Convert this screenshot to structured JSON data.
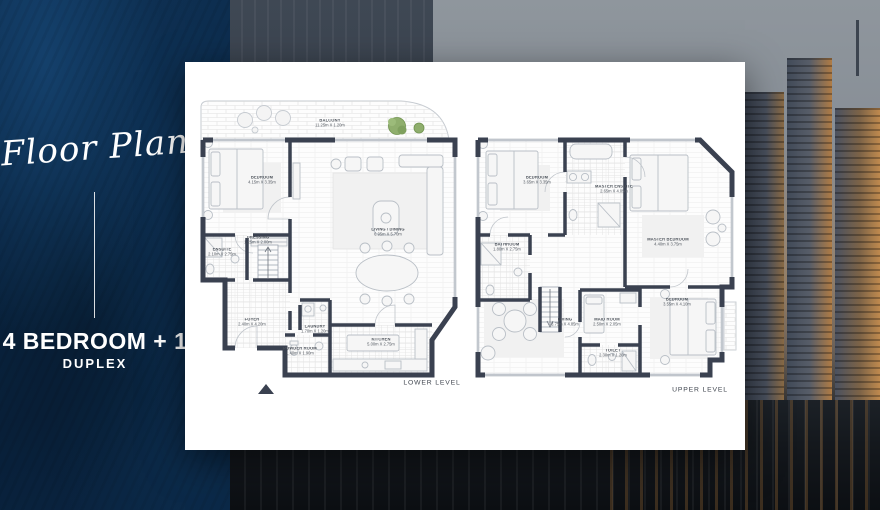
{
  "panel": {
    "script_title": "Floor Plan",
    "headline": "4 BEDROOM + 1",
    "subheadline": "DUPLEX"
  },
  "plans": {
    "lower": {
      "level_label": "LOWER LEVEL",
      "rooms": [
        {
          "name": "BALCONY",
          "dims": "11.25m X 1.20m"
        },
        {
          "name": "BEDROOM",
          "dims": "4.15m X 3.35m"
        },
        {
          "name": "DRESSING",
          "dims": "1.25m X 2.00m"
        },
        {
          "name": "ENSUITE",
          "dims": "2.10m X 2.75m"
        },
        {
          "name": "LIVING / DINING",
          "dims": "6.95m X 5.70m"
        },
        {
          "name": "FOYER",
          "dims": "2.40m X 4.20m"
        },
        {
          "name": "LAUNDRY",
          "dims": "1.70m X 1.20m"
        },
        {
          "name": "POWDER ROOM",
          "dims": "1.40m X 1.90m"
        },
        {
          "name": "KITCHEN",
          "dims": "5.00m X 2.75m"
        }
      ]
    },
    "upper": {
      "level_label": "UPPER LEVEL",
      "rooms": [
        {
          "name": "BEDROOM",
          "dims": "3.65m X 3.35m"
        },
        {
          "name": "MASTER ENSUITE",
          "dims": "2.65m X 4.05m"
        },
        {
          "name": "MASTER BEDROOM",
          "dims": "4.40m X 3.75m"
        },
        {
          "name": "BATHROOM",
          "dims": "1.80m X 2.75m"
        },
        {
          "name": "LIVING",
          "dims": "3.75m X 4.85m"
        },
        {
          "name": "MAID ROOM",
          "dims": "2.50m X 2.05m"
        },
        {
          "name": "BEDROOM",
          "dims": "3.55m X 4.10m"
        },
        {
          "name": "TOILET",
          "dims": "2.30m X 1.20m"
        }
      ]
    }
  },
  "colors": {
    "panel_bg": "#0a2644",
    "wall": "#3a4150",
    "tree": "#8fae6d",
    "lit_window": "#c08a4e"
  }
}
